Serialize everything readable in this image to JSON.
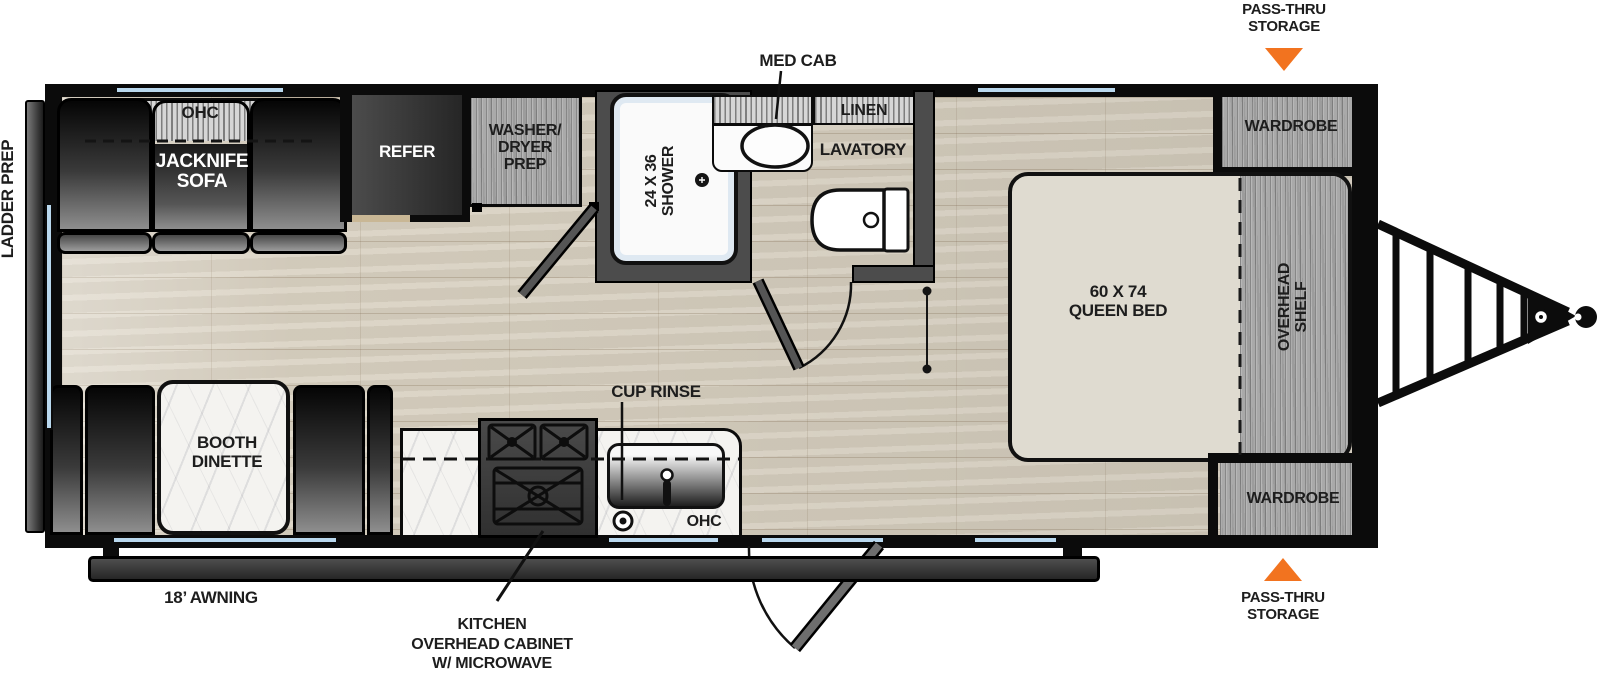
{
  "title": "Travel trailer floor plan",
  "colors": {
    "accent_orange": "#f2731f",
    "window_blue": "#b9d8ee",
    "wall_black": "#0b0b0b",
    "floor_tan": "#d8d0c0",
    "bath_wall_gray": "#4c4c4c",
    "cabinet_gray_wood": "#a9a9a9",
    "bed_beige": "#dfdbd0"
  },
  "exterior": {
    "pass_thru_storage_top": "PASS-THRU\nSTORAGE",
    "pass_thru_storage_bottom": "PASS-THRU\nSTORAGE",
    "ladder_prep": "LADDER PREP",
    "awning": "18’ AWNING",
    "kitchen_cabinet_note": "KITCHEN\nOVERHEAD CABINET\nW/ MICROWAVE"
  },
  "living": {
    "sofa": "JACKNIFE\nSOFA",
    "sofa_ohc": "OHC",
    "refer": "REFER",
    "washer_dryer": "WASHER/\nDRYER\nPREP",
    "dinette": "BOOTH\nDINETTE"
  },
  "kitchen": {
    "cup_rinse": "CUP RINSE",
    "ohc": "OHC"
  },
  "bath": {
    "shower": "24 X 36\nSHOWER",
    "med_cab": "MED CAB",
    "linen": "LINEN",
    "lavatory": "LAVATORY"
  },
  "bedroom": {
    "bed": "60 X 74\nQUEEN BED",
    "overhead_shelf": "OVERHEAD\nSHELF",
    "wardrobe_top": "WARDROBE",
    "wardrobe_bottom": "WARDROBE"
  }
}
